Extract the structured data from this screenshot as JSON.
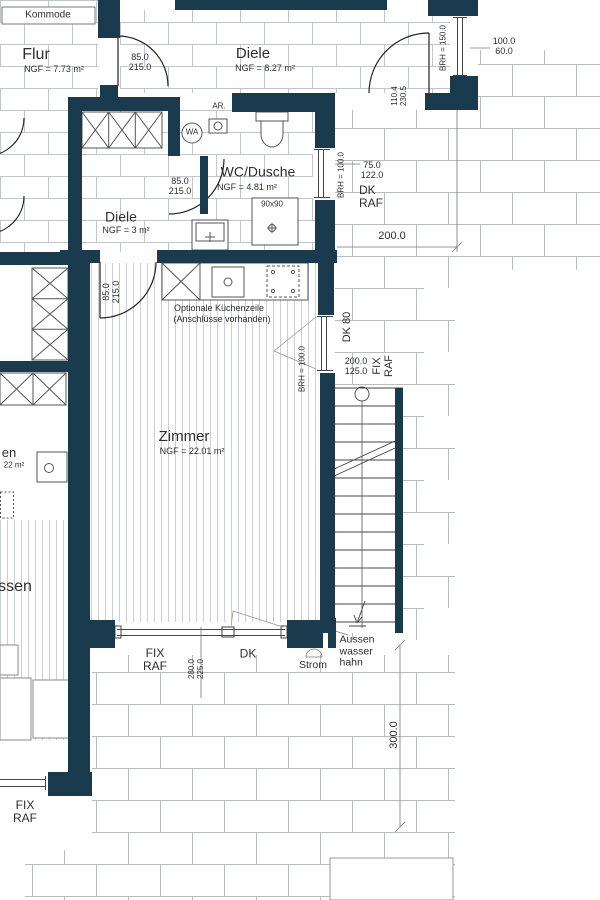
{
  "colors": {
    "wall": "#1a3a4e",
    "floor_tile_line": "#c2c5c9",
    "terrace_line": "#b9bcbf",
    "parquet_line": "#cdd0d3",
    "drawing_line": "#555555",
    "text": "#2e2e2e"
  },
  "rooms": {
    "flur": {
      "name": "Flur",
      "area": "NGF = 7.73 m²"
    },
    "diele_top": {
      "name": "Diele",
      "area": "NGF = 8.27 m²"
    },
    "wc_dusche": {
      "name": "WC/Dusche",
      "area": "NGF = 4.81 m²"
    },
    "diele_small": {
      "name": "Diele",
      "area": "NGF = 3 m²"
    },
    "zimmer": {
      "name": "Zimmer",
      "area": "NGF = 22.01 m²"
    },
    "neighbor": {
      "fragment_en": "en",
      "fragment_area": "22 m²",
      "fragment_ssen": "ssen"
    }
  },
  "furniture": {
    "kommode": "Kommode",
    "washing_machine": "WA",
    "drain_outlet": "AR.",
    "shower_size": "90x90",
    "kitchen_note_line1": "Optionale Küchenzeile",
    "kitchen_note_line2": "(Anschlüsse vorhanden)"
  },
  "dims": {
    "door_flur": [
      "85.0",
      "215.0"
    ],
    "door_diele_small": [
      "85.0",
      "215.0"
    ],
    "door_zimmer": [
      "85.0",
      "215.0"
    ],
    "entrance_door": [
      "110.4",
      "230.5"
    ],
    "window_top_right": [
      "100.0",
      "60.0"
    ],
    "window_top_right_brh": "BRH = 150.0",
    "window_wc": [
      "75.0",
      "122.0"
    ],
    "window_wc_brh": "BRH = 100.0",
    "window_wc_type": [
      "DK",
      "RAF"
    ],
    "terrace_width": "200.0",
    "stair_door": "DK 80",
    "window_zimmer_east": [
      "200.0",
      "125.0"
    ],
    "window_zimmer_east_brh": "BRH = 100.0",
    "window_zimmer_east_type": [
      "FIX",
      "RAF"
    ],
    "window_zimmer_south": [
      "280.0",
      "225.0"
    ],
    "window_zimmer_south_fix": [
      "FIX",
      "RAF"
    ],
    "window_zimmer_south_dk": "DK",
    "window_neighbor_type": [
      "FIX",
      "RAF"
    ],
    "terrace_height": "300.0"
  },
  "annotations": {
    "strom": "Strom",
    "aussenwasserhahn": [
      "Aussen",
      "wasser",
      "hahn"
    ]
  }
}
